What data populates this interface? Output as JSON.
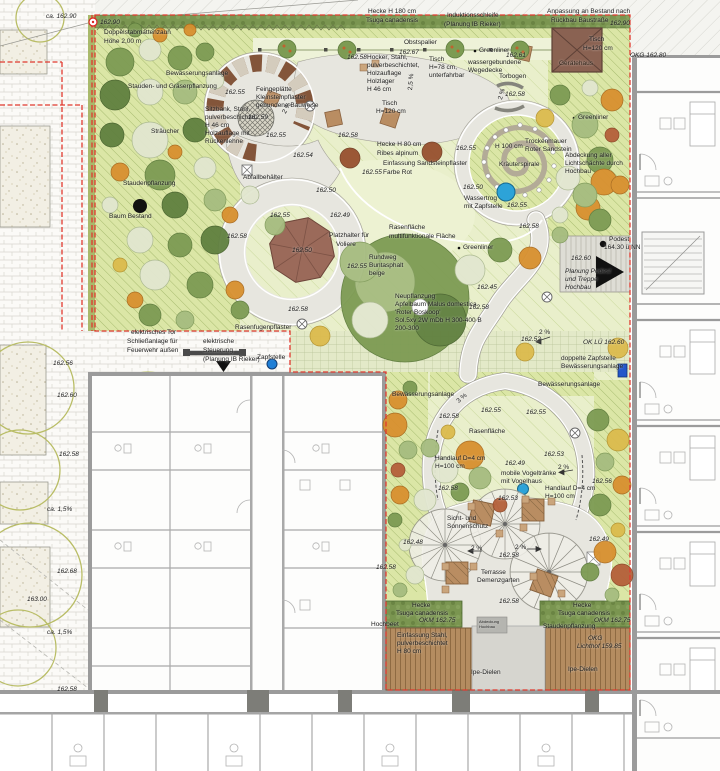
{
  "plan": {
    "garden_label": "Demenzgarten",
    "drawing_kind": "Freianlagenplan"
  },
  "colors": {
    "boundary_red": "#e0392e",
    "lawn_green": "#e9efcb",
    "planting_green": "#dbe6a6",
    "path_grey": "#e7e6df",
    "water_blue": "#2da3d8",
    "tap_blue": "#2456c9",
    "wood_brown": "#b48c60",
    "hedge_green": "#7a9550",
    "shed_brown": "#8a6252",
    "voliere_brown": "#9b6a5a"
  },
  "symbols": {
    "existing_tree_marker": "solid black circle",
    "podest_point_marker": "black dot",
    "entrance_arrow": "black triangle",
    "water_trough_marker": "blue circle",
    "tap_marker": "blue dot",
    "double_tap_marker": "blue square",
    "drain_marker": "circled X",
    "waste_bin_marker": "boxed X",
    "sun_umbrella": "spoked wheel",
    "herb_spiral": "stone spiral"
  },
  "labels": [
    {
      "t": "ca. 162.90",
      "x": 46,
      "y": 14,
      "i": 1
    },
    {
      "t": "162.90",
      "x": 100,
      "y": 20,
      "i": 1
    },
    {
      "t": "Doppelstabmattenzaun",
      "x": 104,
      "y": 30
    },
    {
      "t": "Höhe 2,00 m",
      "x": 104,
      "y": 39
    },
    {
      "t": "Hecke H 180 cm",
      "x": 368,
      "y": 9
    },
    {
      "t": "Tsuga canadensis",
      "x": 366,
      "y": 18
    },
    {
      "t": "Induktionsschleife",
      "x": 447,
      "y": 13
    },
    {
      "t": "(Planung IB Rieker)",
      "x": 444,
      "y": 22
    },
    {
      "t": "Anpassung an Bestand nach",
      "x": 547,
      "y": 9
    },
    {
      "t": "Rückbau Baustraße",
      "x": 551,
      "y": 18
    },
    {
      "t": "162.90",
      "x": 610,
      "y": 21,
      "i": 1
    },
    {
      "t": "OKG 162.80",
      "x": 630,
      "y": 53,
      "i": 1
    },
    {
      "t": "Obstspalier",
      "x": 404,
      "y": 40
    },
    {
      "t": "162.67",
      "x": 399,
      "y": 50,
      "i": 1
    },
    {
      "t": "Greenliner",
      "x": 479,
      "y": 48
    },
    {
      "t": "162.61",
      "x": 506,
      "y": 53,
      "i": 1
    },
    {
      "t": "Tisch",
      "x": 589,
      "y": 37
    },
    {
      "t": "H=120 cm",
      "x": 583,
      "y": 46
    },
    {
      "t": "Gerätehaus",
      "x": 559,
      "y": 61,
      "c": "#2e2217"
    },
    {
      "t": "162.58",
      "x": 347,
      "y": 55,
      "i": 1
    },
    {
      "t": "Hocker, Stahl,",
      "x": 367,
      "y": 55
    },
    {
      "t": "pulverbeschichtet,",
      "x": 367,
      "y": 63
    },
    {
      "t": "Holzauflage",
      "x": 367,
      "y": 71
    },
    {
      "t": "Holzlager",
      "x": 367,
      "y": 79
    },
    {
      "t": "H 46 cm",
      "x": 367,
      "y": 87
    },
    {
      "t": "Tisch",
      "x": 429,
      "y": 57
    },
    {
      "t": "H=78 cm,",
      "x": 429,
      "y": 65
    },
    {
      "t": "unterfahrbar",
      "x": 429,
      "y": 73
    },
    {
      "t": "wassergebundene",
      "x": 468,
      "y": 60
    },
    {
      "t": "Wegedecke",
      "x": 468,
      "y": 68
    },
    {
      "t": "Torbogen",
      "x": 499,
      "y": 74
    },
    {
      "t": "162.58",
      "x": 505,
      "y": 92,
      "i": 1
    },
    {
      "t": "2 %",
      "x": 498,
      "y": 99,
      "r": -75
    },
    {
      "t": "2,5 %",
      "x": 408,
      "y": 90,
      "r": -85
    },
    {
      "t": "Bewässerungsanlage",
      "x": 166,
      "y": 71
    },
    {
      "t": "Stauden- und Gräserpflanzung",
      "x": 128,
      "y": 84
    },
    {
      "t": "162.55",
      "x": 225,
      "y": 90,
      "i": 1
    },
    {
      "t": "Feingeplätte",
      "x": 256,
      "y": 87
    },
    {
      "t": "Kleinsteinpflaster",
      "x": 256,
      "y": 95
    },
    {
      "t": "gebundene Bauweise",
      "x": 256,
      "y": 103
    },
    {
      "t": "Sitzbank, Stahl,",
      "x": 205,
      "y": 107
    },
    {
      "t": "pulverbeschichtet,",
      "x": 205,
      "y": 115
    },
    {
      "t": "H 46 cm",
      "x": 205,
      "y": 123
    },
    {
      "t": "Holzauflage mit",
      "x": 205,
      "y": 131
    },
    {
      "t": "Rückenlehne",
      "x": 205,
      "y": 139
    },
    {
      "t": "162.59",
      "x": 248,
      "y": 115,
      "i": 1
    },
    {
      "t": "Tisch",
      "x": 382,
      "y": 101
    },
    {
      "t": "H=120 cm",
      "x": 376,
      "y": 109
    },
    {
      "t": "162.55",
      "x": 266,
      "y": 133,
      "i": 1
    },
    {
      "t": "2 %",
      "x": 282,
      "y": 112,
      "r": -60
    },
    {
      "t": "162.58",
      "x": 338,
      "y": 133,
      "i": 1
    },
    {
      "t": "Sträucher",
      "x": 151,
      "y": 129
    },
    {
      "t": "162.54",
      "x": 293,
      "y": 153,
      "i": 1
    },
    {
      "t": "Hecke H 80 cm",
      "x": 377,
      "y": 142
    },
    {
      "t": "Ribes alpinum",
      "x": 377,
      "y": 151
    },
    {
      "t": "Einfassung Sandsteinpflaster",
      "x": 383,
      "y": 161
    },
    {
      "t": "Farbe Rot",
      "x": 383,
      "y": 170
    },
    {
      "t": "162.55",
      "x": 362,
      "y": 170,
      "i": 1
    },
    {
      "t": "162.55",
      "x": 456,
      "y": 146,
      "i": 1
    },
    {
      "t": "H 100 cm",
      "x": 495,
      "y": 144
    },
    {
      "t": "Trockenmauer",
      "x": 525,
      "y": 139
    },
    {
      "t": "Roter Sandstein",
      "x": 525,
      "y": 147
    },
    {
      "t": "Kräuterspirale",
      "x": 499,
      "y": 162
    },
    {
      "t": "Greenliner",
      "x": 578,
      "y": 115
    },
    {
      "t": "Abdeckung aller",
      "x": 565,
      "y": 153
    },
    {
      "t": "Lichtschächte durch",
      "x": 565,
      "y": 161
    },
    {
      "t": "Hochbau",
      "x": 565,
      "y": 169
    },
    {
      "t": "Staudenpflanzung",
      "x": 123,
      "y": 181
    },
    {
      "t": "Abfallbehälter",
      "x": 243,
      "y": 175
    },
    {
      "t": "162.50",
      "x": 316,
      "y": 188,
      "i": 1
    },
    {
      "t": "162.50",
      "x": 463,
      "y": 185,
      "i": 1
    },
    {
      "t": "Wassertrog",
      "x": 464,
      "y": 196
    },
    {
      "t": "mit Zapfstelle",
      "x": 464,
      "y": 204
    },
    {
      "t": "162.55",
      "x": 507,
      "y": 203,
      "i": 1
    },
    {
      "t": "Baum Bestand",
      "x": 109,
      "y": 214
    },
    {
      "t": "162.55",
      "x": 270,
      "y": 213,
      "i": 1
    },
    {
      "t": "162.49",
      "x": 330,
      "y": 213,
      "i": 1
    },
    {
      "t": "Rasenfläche",
      "x": 389,
      "y": 225
    },
    {
      "t": "multifunktionale Fläche",
      "x": 389,
      "y": 234
    },
    {
      "t": "162.58",
      "x": 519,
      "y": 224,
      "i": 1
    },
    {
      "t": "162.58",
      "x": 227,
      "y": 234,
      "i": 1
    },
    {
      "t": "Podest",
      "x": 609,
      "y": 237
    },
    {
      "t": "164.30 ü NN",
      "x": 604,
      "y": 245
    },
    {
      "t": "162.60",
      "x": 571,
      "y": 256,
      "i": 1
    },
    {
      "t": "Platzhalter für",
      "x": 329,
      "y": 233
    },
    {
      "t": "Voliere",
      "x": 336,
      "y": 242
    },
    {
      "t": "162.50",
      "x": 292,
      "y": 248,
      "i": 1
    },
    {
      "t": "Greenliner",
      "x": 463,
      "y": 245
    },
    {
      "t": "Rundweg",
      "x": 369,
      "y": 255
    },
    {
      "t": "Buntasphalt",
      "x": 369,
      "y": 263
    },
    {
      "t": "beige",
      "x": 369,
      "y": 271
    },
    {
      "t": "162.55",
      "x": 347,
      "y": 264,
      "i": 1
    },
    {
      "t": "Planung Podest",
      "x": 565,
      "y": 269,
      "i": 1
    },
    {
      "t": "und Treppe",
      "x": 565,
      "y": 277,
      "i": 1
    },
    {
      "t": "Hochbau",
      "x": 565,
      "y": 285,
      "i": 1
    },
    {
      "t": "Neupflanzung",
      "x": 395,
      "y": 294
    },
    {
      "t": "Apfelbaum Malus domestica",
      "x": 395,
      "y": 302
    },
    {
      "t": "'Roter Boskoop'",
      "x": 395,
      "y": 310
    },
    {
      "t": "Sol.5xv 2W mDb H 300-400 B",
      "x": 395,
      "y": 318
    },
    {
      "t": "200-300",
      "x": 395,
      "y": 326
    },
    {
      "t": "162.45",
      "x": 477,
      "y": 285,
      "i": 1
    },
    {
      "t": "162.58",
      "x": 469,
      "y": 305,
      "i": 1
    },
    {
      "t": "162.58",
      "x": 288,
      "y": 307,
      "i": 1
    },
    {
      "t": "Rasenfugenpflaster",
      "x": 235,
      "y": 325
    },
    {
      "t": "2 %",
      "x": 539,
      "y": 330
    },
    {
      "t": "162.52",
      "x": 521,
      "y": 337,
      "i": 1
    },
    {
      "t": "OK LÜ 162.60",
      "x": 583,
      "y": 340,
      "i": 1
    },
    {
      "t": "elektrisches Tor",
      "x": 131,
      "y": 330
    },
    {
      "t": "Schließanlage für",
      "x": 127,
      "y": 339
    },
    {
      "t": "Feuerwehr außen",
      "x": 127,
      "y": 348
    },
    {
      "t": "elektrische",
      "x": 203,
      "y": 339
    },
    {
      "t": "Steuerung",
      "x": 203,
      "y": 348
    },
    {
      "t": "(Planung IB Rieker)",
      "x": 203,
      "y": 357
    },
    {
      "t": "Zapfstelle",
      "x": 257,
      "y": 355
    },
    {
      "t": "doppelte Zapfstelle",
      "x": 561,
      "y": 356
    },
    {
      "t": "Bewässerungsanlage",
      "x": 561,
      "y": 364
    },
    {
      "t": "Bewässerungsanlage",
      "x": 538,
      "y": 382
    },
    {
      "t": "162.56",
      "x": 53,
      "y": 361,
      "i": 1
    },
    {
      "t": "162.60",
      "x": 57,
      "y": 393,
      "i": 1
    },
    {
      "t": "Bewässerungsanlage",
      "x": 392,
      "y": 392
    },
    {
      "t": "3 %",
      "x": 456,
      "y": 400,
      "r": -40
    },
    {
      "t": "162.55",
      "x": 481,
      "y": 408,
      "i": 1
    },
    {
      "t": "162.55",
      "x": 526,
      "y": 410,
      "i": 1
    },
    {
      "t": "162.58",
      "x": 439,
      "y": 414,
      "i": 1
    },
    {
      "t": "Rasenfläche",
      "x": 469,
      "y": 429
    },
    {
      "t": "162.58",
      "x": 59,
      "y": 452,
      "i": 1
    },
    {
      "t": "Handlauf D=4 cm",
      "x": 435,
      "y": 456
    },
    {
      "t": "H=100 cm",
      "x": 435,
      "y": 464
    },
    {
      "t": "162.49",
      "x": 505,
      "y": 461,
      "i": 1
    },
    {
      "t": "162.53",
      "x": 544,
      "y": 452,
      "i": 1
    },
    {
      "t": "mobile Vogeltränke",
      "x": 501,
      "y": 471
    },
    {
      "t": "mit Vogelhaus",
      "x": 501,
      "y": 479
    },
    {
      "t": "2 %",
      "x": 558,
      "y": 465
    },
    {
      "t": "162.56",
      "x": 592,
      "y": 479,
      "i": 1
    },
    {
      "t": "162.58",
      "x": 438,
      "y": 486,
      "i": 1
    },
    {
      "t": "Handlauf D=4 cm",
      "x": 545,
      "y": 486
    },
    {
      "t": "H=100 cm",
      "x": 545,
      "y": 494
    },
    {
      "t": "162.53",
      "x": 498,
      "y": 496,
      "i": 1
    },
    {
      "t": "ca. 1,5%",
      "x": 47,
      "y": 507,
      "i": 1
    },
    {
      "t": "Sicht- und",
      "x": 447,
      "y": 516
    },
    {
      "t": "Sonnenschutz",
      "x": 447,
      "y": 524
    },
    {
      "t": "162.48",
      "x": 403,
      "y": 540,
      "i": 1
    },
    {
      "t": "2 %",
      "x": 471,
      "y": 546
    },
    {
      "t": "2 %",
      "x": 515,
      "y": 545
    },
    {
      "t": "162.58",
      "x": 499,
      "y": 553,
      "i": 1
    },
    {
      "t": "162.49",
      "x": 589,
      "y": 537,
      "i": 1
    },
    {
      "t": "162.58",
      "x": 376,
      "y": 565,
      "i": 1
    },
    {
      "t": "162.68",
      "x": 57,
      "y": 569,
      "i": 1
    },
    {
      "t": "Terrasse",
      "x": 481,
      "y": 570
    },
    {
      "t": "Demenzgarten",
      "x": 477,
      "y": 578
    },
    {
      "t": "163.00",
      "x": 27,
      "y": 597,
      "i": 1
    },
    {
      "t": "162.58",
      "x": 499,
      "y": 599,
      "i": 1
    },
    {
      "t": "Hecke",
      "x": 412,
      "y": 603
    },
    {
      "t": "Tsuga canadensis",
      "x": 396,
      "y": 611
    },
    {
      "t": "Hecke",
      "x": 573,
      "y": 603
    },
    {
      "t": "Tsuga canadensis",
      "x": 558,
      "y": 611
    },
    {
      "t": "OKM 162.75",
      "x": 419,
      "y": 618,
      "i": 1
    },
    {
      "t": "OKM 162.75",
      "x": 594,
      "y": 618,
      "i": 1
    },
    {
      "t": "Hochbeet",
      "x": 371,
      "y": 622
    },
    {
      "t": "Staudenpflanzung",
      "x": 543,
      "y": 624
    },
    {
      "t": "Abdeckung",
      "x": 479,
      "y": 620,
      "s": 4
    },
    {
      "t": "Hochbau",
      "x": 479,
      "y": 625,
      "s": 4
    },
    {
      "t": "Einfassung Stahl,",
      "x": 397,
      "y": 633
    },
    {
      "t": "pulverbeschichtet",
      "x": 397,
      "y": 641
    },
    {
      "t": "H 80 cm",
      "x": 397,
      "y": 649
    },
    {
      "t": "ca. 1,5%",
      "x": 47,
      "y": 630,
      "i": 1
    },
    {
      "t": "Ipe-Dielen",
      "x": 471,
      "y": 670
    },
    {
      "t": "Ipe-Dielen",
      "x": 568,
      "y": 667
    },
    {
      "t": "OKG",
      "x": 588,
      "y": 636,
      "i": 1
    },
    {
      "t": "Lichthof 159.85",
      "x": 577,
      "y": 644,
      "i": 1
    },
    {
      "t": "162.58",
      "x": 57,
      "y": 687,
      "i": 1
    }
  ]
}
